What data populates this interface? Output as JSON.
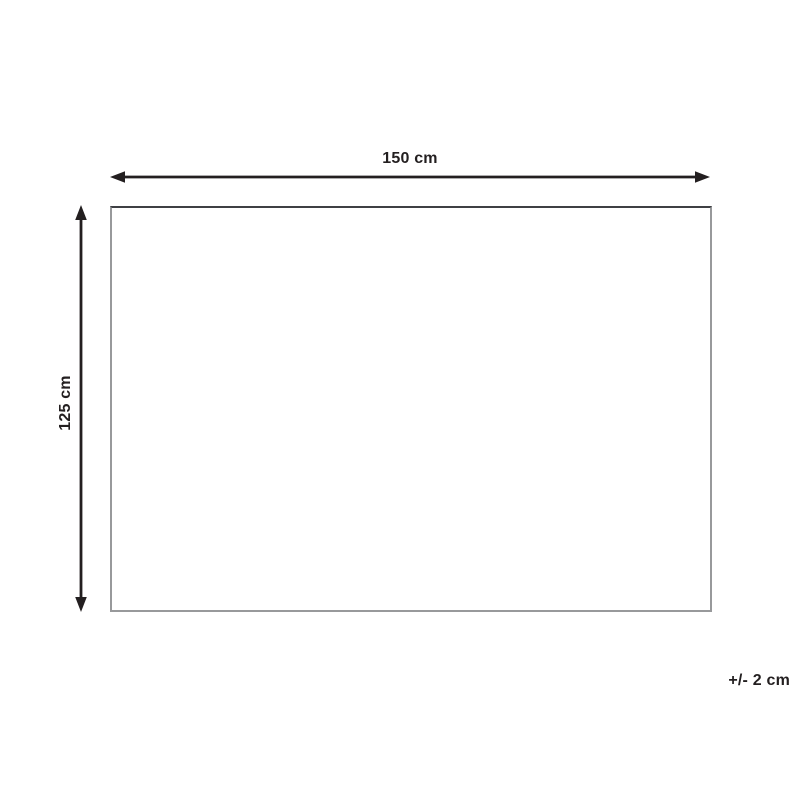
{
  "diagram": {
    "type": "product-dimension-diagram",
    "width_label": "150 cm",
    "height_label": "125 cm",
    "tolerance_label": "+/- 2 cm"
  },
  "icons": {
    "width_arrow": "horizontal-double-arrow-icon",
    "height_arrow": "vertical-double-arrow-icon"
  },
  "colors": {
    "arrow": "#231f20",
    "text": "#231f20",
    "rect_border_top": "#3f4044",
    "rect_border_sides": "#98999b",
    "background": "#ffffff"
  }
}
